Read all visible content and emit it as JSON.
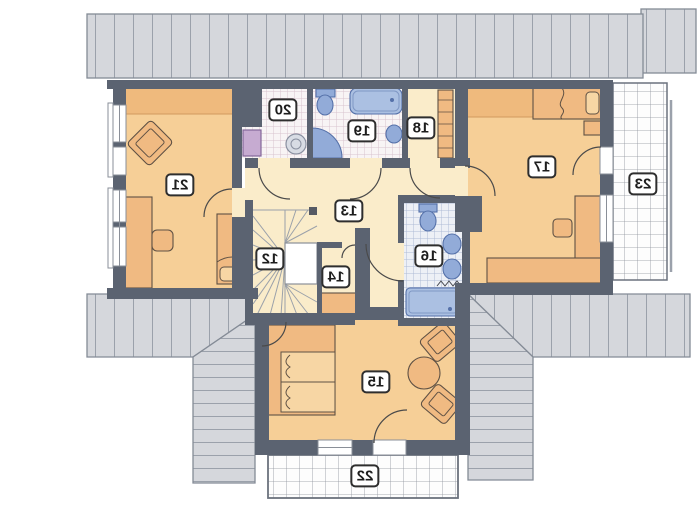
{
  "title": "attic floor plan",
  "rooms": [
    {
      "label": "12"
    },
    {
      "label": "13"
    },
    {
      "label": "14"
    },
    {
      "label": "15"
    },
    {
      "label": "16"
    },
    {
      "label": "17"
    },
    {
      "label": "18"
    },
    {
      "label": "19"
    },
    {
      "label": "20"
    },
    {
      "label": "21"
    },
    {
      "label": "22"
    },
    {
      "label": "23"
    }
  ],
  "colors": {
    "wall": "#5b6371",
    "roof_fill": "#d5d7dc",
    "roof_line": "#9ba1ab",
    "roof_edge": "#848b96",
    "cream": "#faecca",
    "orange": "#f6cf97",
    "orange_dark": "#efba7d",
    "orange_line": "#d19a5e",
    "furn": "#f0ba82",
    "furn_light": "#f7d6a4",
    "furn_edge": "#5f5144",
    "blue": "#92abd8",
    "blue_light": "#abc0e2",
    "blue_edge": "#5571a9",
    "tile_pink_bg": "#f8f4f5",
    "tile_pink_line": "#d9c3cf",
    "tile_blue_bg": "#edf0f6",
    "tile_blue_line": "#aebbd6",
    "purple": "#c6abd1",
    "purple_edge": "#84689a",
    "grid_bg": "#fdfdfd",
    "grid_line": "#8d939c",
    "label_border": "#2e2e2e",
    "label_bg": "#ffffff",
    "ink": "#1d1d1d",
    "void": "#ffffff",
    "stair_line": "#9ba1aa",
    "door": "#4a4a4a"
  }
}
